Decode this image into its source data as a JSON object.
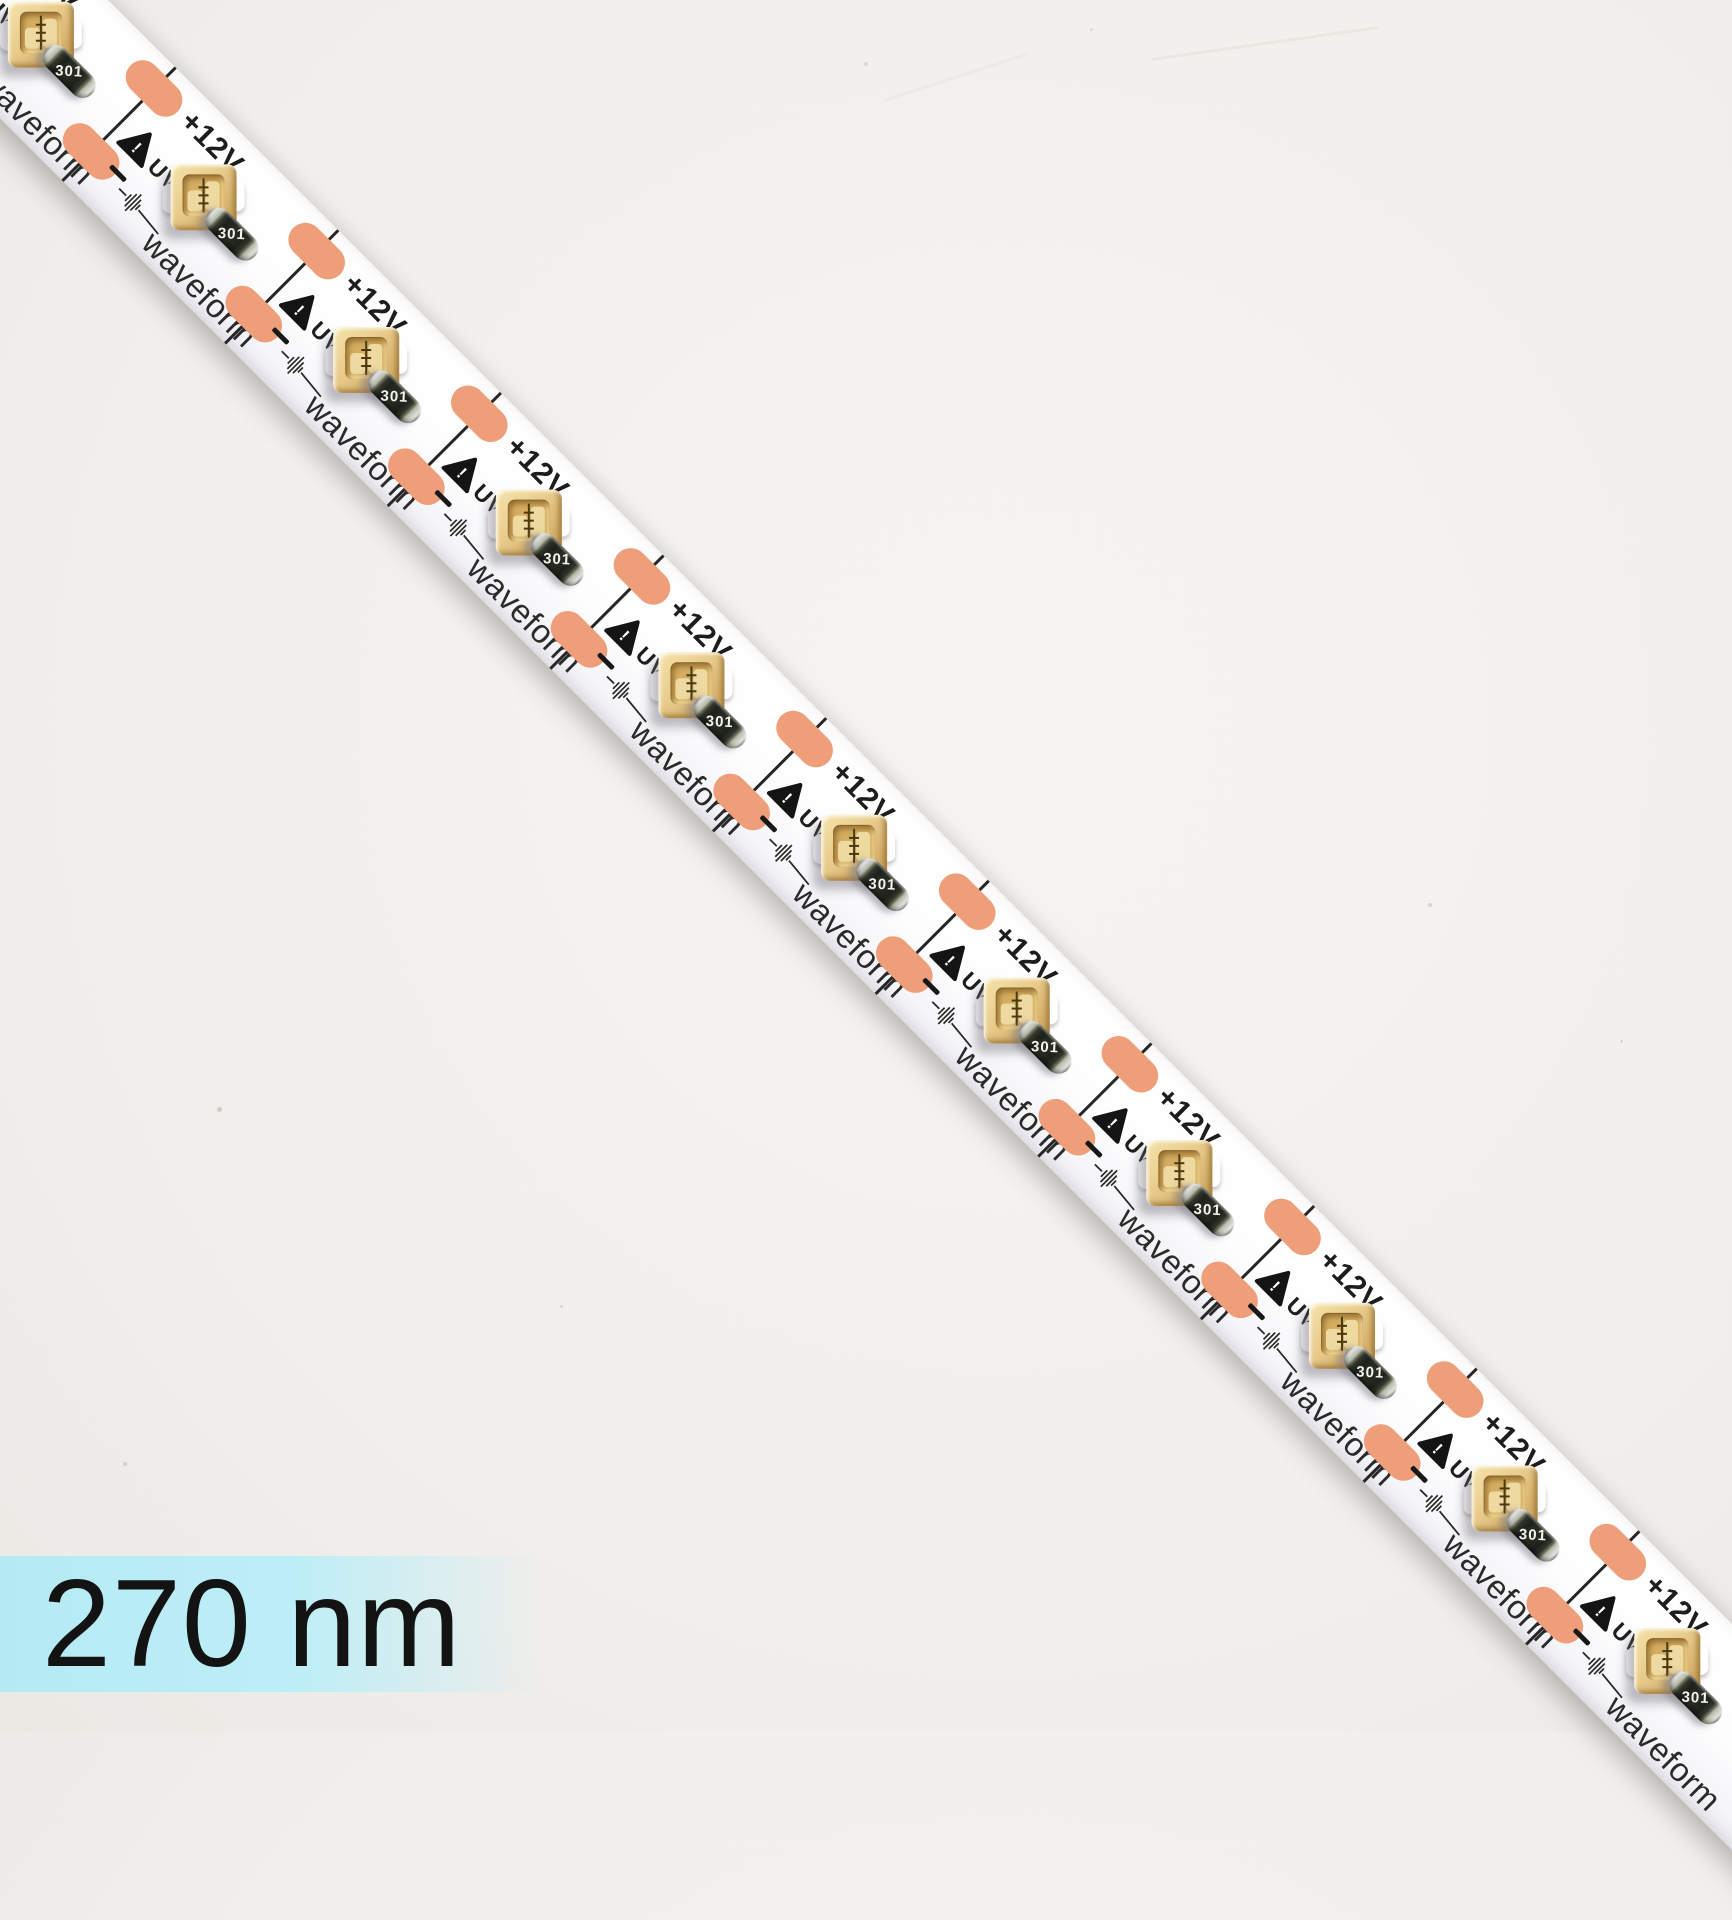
{
  "image_type": "product-photo",
  "product": {
    "description": "UV-C LED flexible strip light on white background, diagonal orientation",
    "brand": "waveform"
  },
  "label": {
    "text": "270 nm",
    "band_color": "#b9ecf6",
    "text_color": "#131313"
  },
  "background": {
    "color": "#f1efec",
    "specks": [
      {
        "x": 864,
        "y": 62,
        "size": 4,
        "opacity": 0.18
      },
      {
        "x": 1090,
        "y": 28,
        "size": 3,
        "opacity": 0.15
      },
      {
        "x": 1428,
        "y": 903,
        "size": 4,
        "opacity": 0.22
      },
      {
        "x": 217,
        "y": 1107,
        "size": 5,
        "opacity": 0.25
      },
      {
        "x": 1620,
        "y": 1040,
        "size": 3,
        "opacity": 0.16
      },
      {
        "x": 560,
        "y": 1305,
        "size": 3,
        "opacity": 0.18
      },
      {
        "x": 123,
        "y": 1462,
        "size": 4,
        "opacity": 0.2
      }
    ],
    "streaks": [
      {
        "x": 1150,
        "y": 42,
        "w": 230,
        "rot": -8,
        "opacity": 0.14
      },
      {
        "x": 880,
        "y": 76,
        "w": 150,
        "rot": -18,
        "opacity": 0.1
      }
    ]
  },
  "strip": {
    "segment_count": 12,
    "pitch_px": 230,
    "angle_deg": 45,
    "pcb_color": "#fdfdfe",
    "pad_color": "#ee9e79",
    "cutline_color": "#262626",
    "segment": {
      "voltage_label": "+12V",
      "uv_label": "UV-C",
      "minus_label": "–",
      "brand_label": "waveform",
      "resistor_code": "301",
      "exclamation": "!"
    },
    "led": {
      "body_color": "#e9cc8d",
      "recess_color": "#d5ad61",
      "solder_color": "#ffffff"
    },
    "resistor": {
      "body_color": "#2a2d24",
      "cap_color": "#d9d9d3",
      "code": "301"
    }
  }
}
